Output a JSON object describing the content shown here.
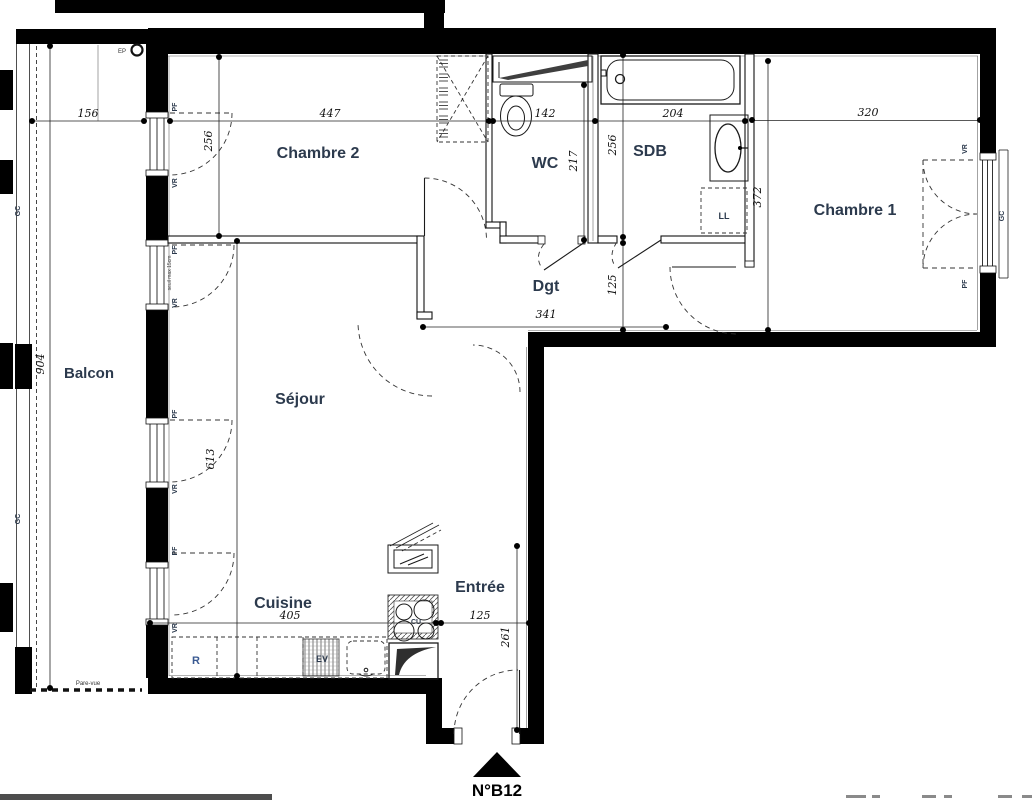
{
  "unit": {
    "label": "N°B12"
  },
  "rooms": {
    "chambre2": "Chambre 2",
    "wc": "WC",
    "sdb": "SDB",
    "chambre1": "Chambre 1",
    "balcon": "Balcon",
    "sejour": "Séjour",
    "dgt": "Dgt",
    "cuisine": "Cuisine",
    "entree": "Entrée"
  },
  "dims": {
    "balcon_width": "156",
    "chambre2_width": "447",
    "wc_width": "142",
    "sdb_width": "204",
    "chambre1_width": "320",
    "balcon_height": "904",
    "chambre2_height": "256",
    "wc_height": "217",
    "sdb_height": "256",
    "dgt_height": "125",
    "chambre1_height": "372",
    "sejour_height": "613",
    "dgt_width": "341",
    "cuisine_width": "405",
    "entree_width": "125",
    "entree_height": "261"
  },
  "tags": {
    "pf": "PF",
    "vr": "VR",
    "gc": "GC",
    "ll": "LL",
    "ep": "EP",
    "r": "R",
    "ev": "EV",
    "cu": "CU",
    "pare_vue": "Pare-vue",
    "seuil": "seuil max 15cm"
  }
}
